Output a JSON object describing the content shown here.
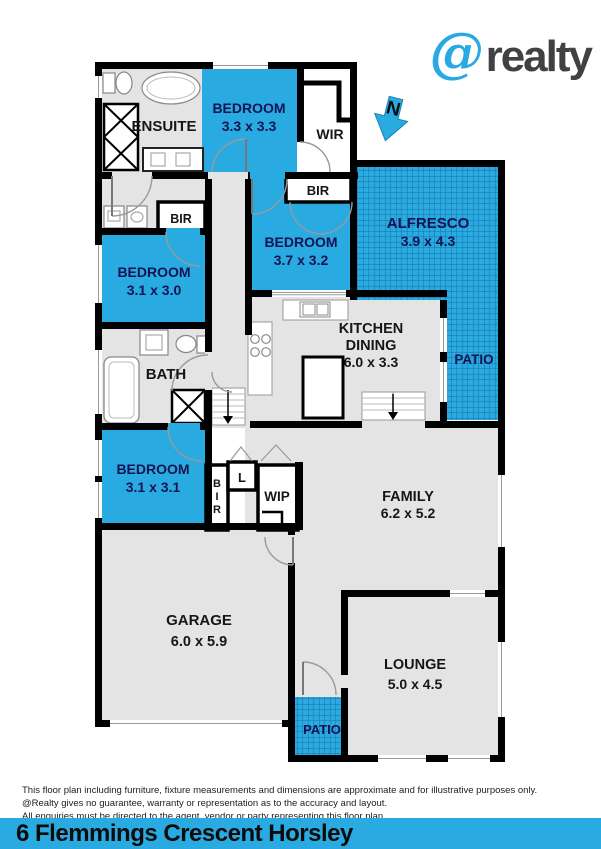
{
  "brand": {
    "at_symbol": "@",
    "wordmark": "realty"
  },
  "compass": {
    "label": "N"
  },
  "plan": {
    "rooms": {
      "ensuite": {
        "label": "ENSUITE"
      },
      "bedroom_top": {
        "label": "BEDROOM",
        "dims": "3.3 x 3.3"
      },
      "wir": {
        "label": "WIR"
      },
      "bir_bedroom_mid": {
        "label": "BIR"
      },
      "bedroom_mid": {
        "label": "BEDROOM",
        "dims": "3.7 x 3.2"
      },
      "alfresco": {
        "label": "ALFRESCO",
        "dims": "3.9 x 4.3"
      },
      "bir_hall": {
        "label": "BIR"
      },
      "bedroom_left": {
        "label": "BEDROOM",
        "dims": "3.1 x 3.0"
      },
      "bath": {
        "label": "BATH"
      },
      "kitchen_dining": {
        "line1": "KITCHEN",
        "line2": "DINING",
        "dims": "6.0 x 3.3"
      },
      "patio_side": {
        "label": "PATIO"
      },
      "bedroom_lower": {
        "label": "BEDROOM",
        "dims": "3.1 x 3.1"
      },
      "bir_vertical": {
        "letter1": "B",
        "letter2": "I",
        "letter3": "R"
      },
      "linen": {
        "label": "L"
      },
      "wip": {
        "label": "WIP"
      },
      "family": {
        "label": "FAMILY",
        "dims": "6.2 x 5.2"
      },
      "garage": {
        "label": "GARAGE",
        "dims": "6.0 x 5.9"
      },
      "lounge": {
        "label": "LOUNGE",
        "dims": "5.0 x 4.5"
      },
      "patio_bottom": {
        "label": "PATIO"
      }
    }
  },
  "disclaimer": {
    "line1": "This floor plan including furniture, fixture measurements and dimensions are approximate and for illustrative purposes only.",
    "line2": "@Realty gives no guarantee, warranty or representation as to the accuracy and layout.",
    "line3": "All enquiries must be directed to the agent, vendor or party representing this floor plan."
  },
  "address_bar": {
    "text": "6 Flemmings Crescent Horsley"
  },
  "colors": {
    "accent_blue": "#29ABE2",
    "room_gray": "#E4E4E4",
    "wall_black": "#000000",
    "label_navy": "#141452",
    "logo_gray": "#414042"
  }
}
